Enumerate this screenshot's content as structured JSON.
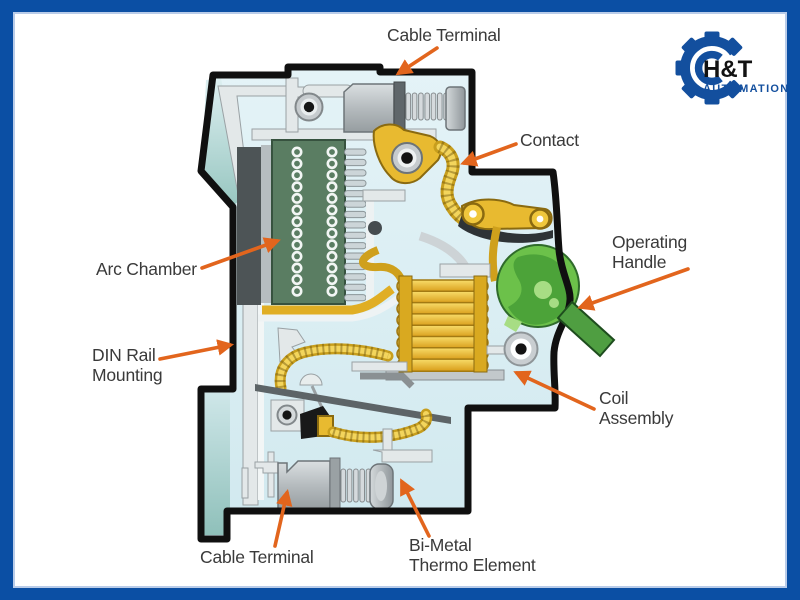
{
  "frame": {
    "color": "#0b4fa4",
    "inner_border": "#b9cce9",
    "background": "#ffffff"
  },
  "logo": {
    "brand": "H&T",
    "subtitle": "AUTOMATION",
    "gear_color": "#134f9e",
    "brand_color": "#121212",
    "subtitle_color": "#134f9e"
  },
  "diagram": {
    "colors": {
      "arrow_orange": "#e2651d",
      "outline_black": "#101010",
      "cavity_blue": "#d8edf3",
      "teal_shade": "#8fc0ba",
      "arc_chamber_green": "#5a7d62",
      "brass_gold": "#e8ba30",
      "coil_yellow": "#f3ca3e",
      "handle_green": "#6cc14a",
      "handle_lever_green": "#4f9e41",
      "metal_gray": "#c6cbce",
      "dark_metal": "#4d5456"
    },
    "details": {
      "arc_hole_columns": 2,
      "arc_hole_rows": 13,
      "splitter_plates": 15,
      "coil_windings": 8,
      "top_screw_threads": 7,
      "bottom_screw_threads": 6
    },
    "labels": [
      {
        "id": "cable-terminal-top",
        "lines": [
          "Cable Terminal"
        ],
        "x": 387,
        "y": 41,
        "arrow": {
          "x1": 437,
          "y1": 48,
          "x2": 399,
          "y2": 73
        }
      },
      {
        "id": "contact",
        "lines": [
          "Contact"
        ],
        "x": 520,
        "y": 146,
        "arrow": {
          "x1": 516,
          "y1": 144,
          "x2": 464,
          "y2": 163
        }
      },
      {
        "id": "arc-chamber",
        "lines": [
          "Arc Chamber"
        ],
        "x": 96,
        "y": 275,
        "arrow": {
          "x1": 202,
          "y1": 268,
          "x2": 277,
          "y2": 241
        }
      },
      {
        "id": "operating-handle",
        "lines": [
          "Operating",
          "Handle"
        ],
        "x": 612,
        "y": 248,
        "arrow": {
          "x1": 688,
          "y1": 269,
          "x2": 581,
          "y2": 307
        }
      },
      {
        "id": "din-rail-mounting",
        "lines": [
          "DIN Rail",
          "Mounting"
        ],
        "x": 92,
        "y": 361,
        "arrow": {
          "x1": 160,
          "y1": 359,
          "x2": 230,
          "y2": 345
        }
      },
      {
        "id": "coil-assembly",
        "lines": [
          "Coil",
          "Assembly"
        ],
        "x": 599,
        "y": 404,
        "arrow": {
          "x1": 594,
          "y1": 409,
          "x2": 517,
          "y2": 373
        }
      },
      {
        "id": "cable-terminal-bottom",
        "lines": [
          "Cable Terminal"
        ],
        "x": 200,
        "y": 563,
        "arrow": {
          "x1": 275,
          "y1": 546,
          "x2": 287,
          "y2": 493
        }
      },
      {
        "id": "bi-metal-thermo-element",
        "lines": [
          "Bi-Metal",
          "Thermo Element"
        ],
        "x": 409,
        "y": 551,
        "arrow": {
          "x1": 429,
          "y1": 536,
          "x2": 402,
          "y2": 482
        }
      }
    ]
  }
}
